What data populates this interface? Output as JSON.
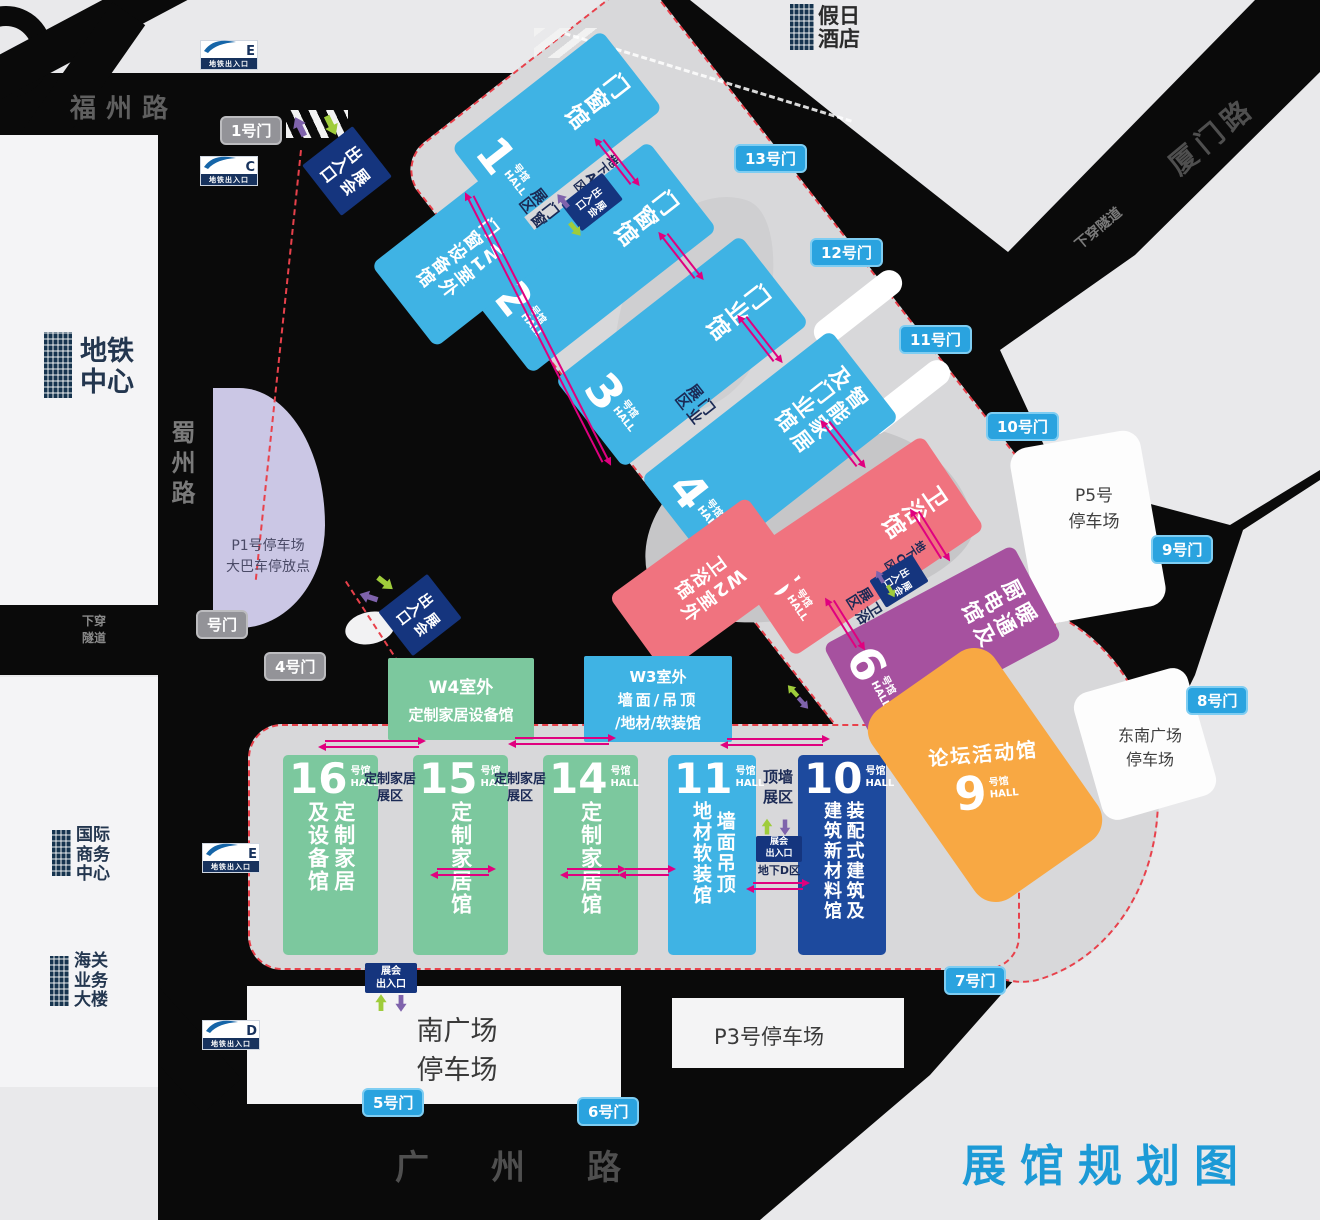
{
  "title": "展馆规划图",
  "colors": {
    "hall_blue": "#3FB3E4",
    "hall_pink": "#F0737F",
    "hall_purple": "#A6519F",
    "hall_green": "#7CC89E",
    "hall_navy": "#1D4A9E",
    "hall_orange": "#F8A843",
    "entrance_navy": "#15357E",
    "gate_blue": "#2AA3DF",
    "gate_gray": "#939398",
    "boundary_red": "#E8414B",
    "arrow_magenta": "#E0007F",
    "arrow_green": "#9FCC3B",
    "arrow_purple": "#7F63AC",
    "title_blue": "#1C9AD6",
    "parking_purple": "#CBC7E5"
  },
  "roads": {
    "fuzhou": "福州路",
    "shuzhou": "蜀州路",
    "xiamen": "厦门路",
    "guangzhou": "广州路",
    "tunnel_left": "下穿\n隧道",
    "tunnel_xiamen": "下穿隧道"
  },
  "landmarks": {
    "hotel": "假日\n酒店",
    "metro_center": "地铁\n中心",
    "intl_business_center": "国际\n商务\n中心",
    "customs_building": "海关\n业务\n大楼"
  },
  "parkings": {
    "p1_l1": "P1号停车场",
    "p1_l2": "大巴车停放点",
    "p5_l1": "P5号",
    "p5_l2": "停车场",
    "p3": "P3号停车场",
    "south_l1": "南广场",
    "south_l2": "停车场",
    "southeast_l1": "东南广场",
    "southeast_l2": "停车场"
  },
  "gates": {
    "g1": "1号门",
    "g_partial": "号门",
    "g4": "4号门",
    "g5": "5号门",
    "g6": "6号门",
    "g7": "7号门",
    "g8": "8号门",
    "g9": "9号门",
    "g10": "10号门",
    "g11": "11号门",
    "g12": "12号门",
    "g13": "13号门"
  },
  "metro": {
    "label": "地铁出入口",
    "e1": "E",
    "c": "C",
    "e2": "E",
    "d": "D"
  },
  "halls": {
    "suffix": "号馆",
    "suffix_en": "HALL",
    "h1": {
      "num": "1",
      "name": "门窗馆"
    },
    "h2": {
      "num": "2",
      "name": "门窗馆"
    },
    "h3": {
      "num": "3",
      "name": "门业馆"
    },
    "h4": {
      "num": "4",
      "name": "智能家居\n及门业馆"
    },
    "h5": {
      "num": "5",
      "name": "卫浴馆"
    },
    "h6": {
      "num": "6",
      "name": "暖通及\n厨电馆"
    },
    "h9": {
      "num": "9",
      "name": "论坛活动馆"
    },
    "h10": {
      "num": "10",
      "name": "装配式建筑及\n建筑新材料馆"
    },
    "h11": {
      "num": "11",
      "name": "墙面吊顶\n地材软装馆"
    },
    "h14": {
      "num": "14",
      "name": "定制家居馆"
    },
    "h15": {
      "num": "15",
      "name": "定制家居馆"
    },
    "h16": {
      "num": "16",
      "name": "定制家居\n及设备馆"
    }
  },
  "outdoor": {
    "w1": "W1室外\n门窗设备馆",
    "w2": "W2室外\n卫浴馆",
    "w3_l1": "W3室外",
    "w3_l2": "墙面/吊顶",
    "w3_l3": "/地材/软装馆",
    "w4_l1": "W4室外",
    "w4_l2": "定制家居设备馆"
  },
  "zones": {
    "menchuang": "门窗\n展区",
    "menye": "门业\n展区",
    "weiyu": "卫浴\n展区",
    "dingqiang": "顶墙\n展区",
    "dingzhi1": "定制家居\n展区",
    "dingzhi2": "定制家居\n展区"
  },
  "entrances": {
    "label_v": "展会\n出入口",
    "label_h": "展会\n出入口",
    "underground_a": "地下A区",
    "underground_c": "地下C区",
    "underground_d": "地下D区"
  }
}
